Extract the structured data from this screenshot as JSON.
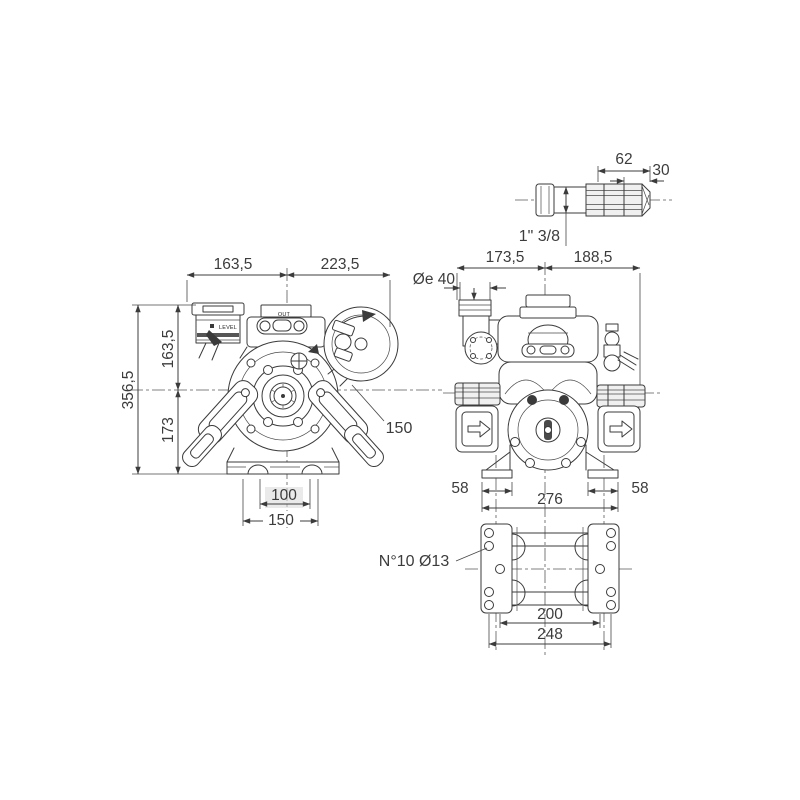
{
  "drawing": {
    "background_color": "#ffffff",
    "line_color": "#3b3b3b",
    "text_color": "#3c3c3c",
    "views": {
      "shaft_detail": {
        "name": "splined PTO shaft detail",
        "dims": {
          "spline_shaft_length": "62",
          "spline_length": "30",
          "shaft_size": "1\" 3/8"
        }
      },
      "front_view": {
        "name": "pump front view",
        "labels": {
          "top_port": "OUT",
          "oil_reservoir": "LEVEL"
        },
        "dims": {
          "top_width_left": "163,5",
          "top_width_right": "223,5",
          "upper_height": "163,5",
          "lower_height": "173",
          "total_height": "356,5",
          "accumulator_diameter": "150",
          "base_inner_width": "100",
          "base_outer_width": "150"
        }
      },
      "side_view": {
        "name": "pump side view",
        "dims": {
          "top_width_left": "173,5",
          "top_width_right": "188,5",
          "oil_fill_diameter": "Øe 40",
          "left_foot_width": "58",
          "feet_overall_width": "276",
          "right_foot_width": "58"
        }
      },
      "base_plate_view": {
        "name": "mounting base bottom view",
        "dims": {
          "holes_note": "N°10 Ø13",
          "inner_hole_span": "200",
          "outer_hole_span": "248"
        }
      }
    }
  }
}
